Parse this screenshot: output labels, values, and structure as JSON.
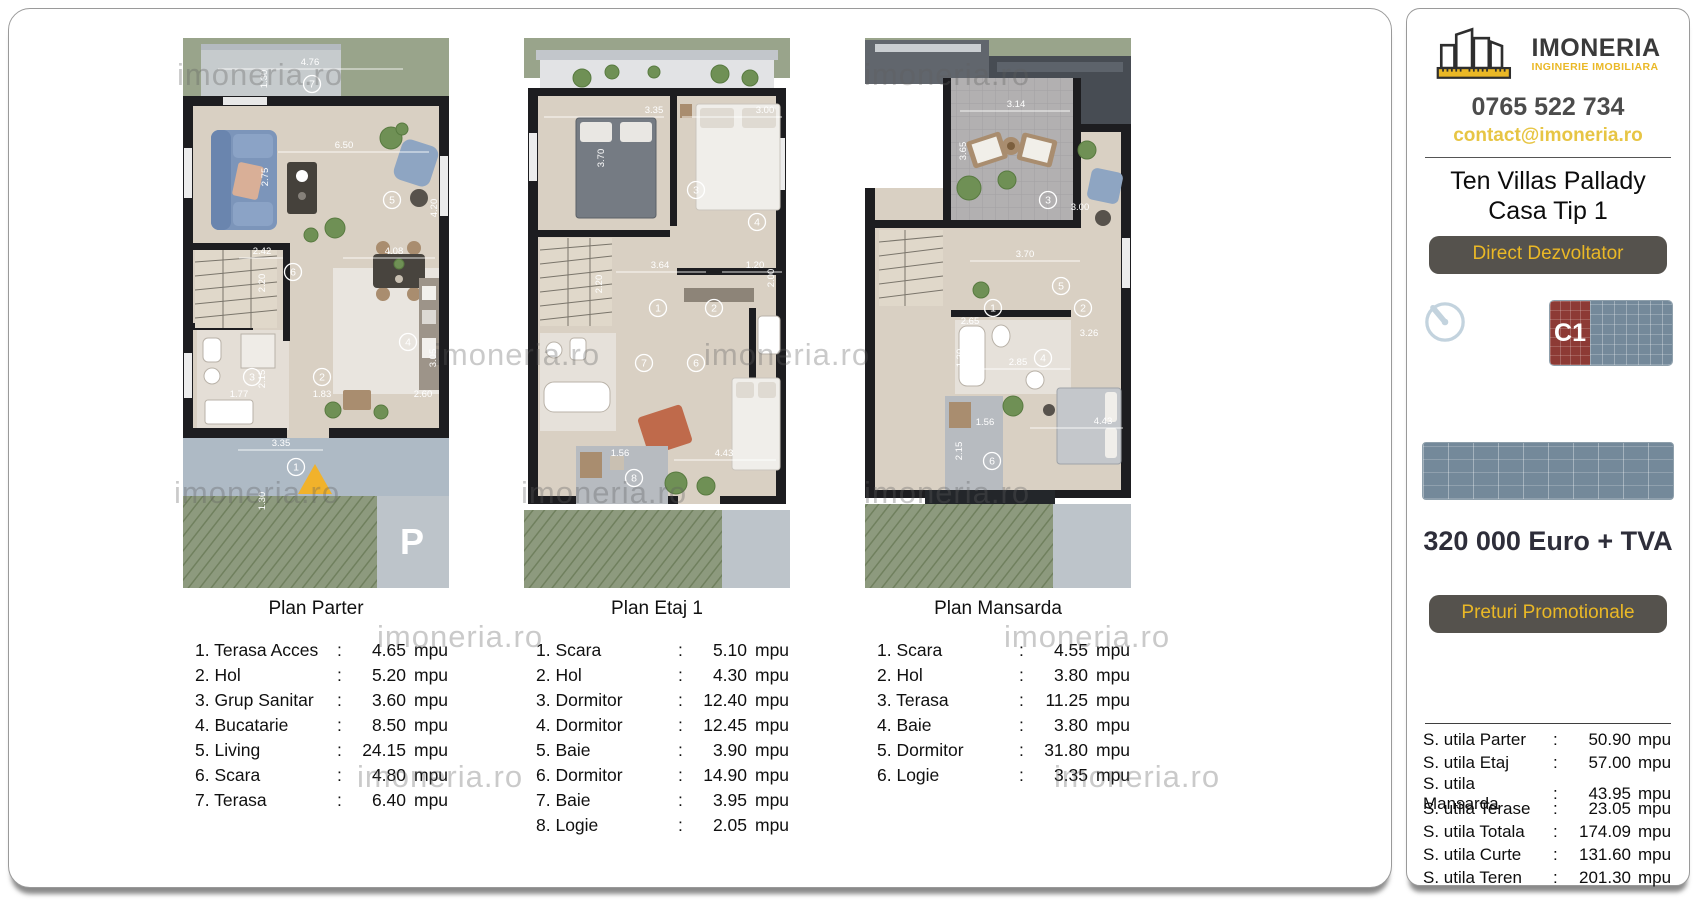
{
  "watermark_text": "imoneria.ro",
  "watermarks": [
    {
      "x": 168,
      "y": 48
    },
    {
      "x": 425,
      "y": 328
    },
    {
      "x": 695,
      "y": 328
    },
    {
      "x": 855,
      "y": 48
    },
    {
      "x": 165,
      "y": 466
    },
    {
      "x": 512,
      "y": 466
    },
    {
      "x": 855,
      "y": 466
    },
    {
      "x": 368,
      "y": 610
    },
    {
      "x": 995,
      "y": 610
    },
    {
      "x": 348,
      "y": 750
    },
    {
      "x": 1045,
      "y": 750
    }
  ],
  "brand": {
    "name": "IMONERIA",
    "tagline": "INGINERIE IMOBILIARA",
    "phone": "0765 522 734",
    "email": "contact@imoneria.ro"
  },
  "listing": {
    "title_line1": "Ten Villas Pallady",
    "title_line2": "Casa Tip 1",
    "developer_badge": "Direct Dezvoltator",
    "price": "320 000 Euro + TVA",
    "promo_button": "Preturi Promotionale",
    "unit_code": "C1"
  },
  "areas": {
    "unit": "mpu",
    "rows": [
      [
        "S. utila Parter",
        "50.90"
      ],
      [
        "S. utila Etaj",
        "57.00"
      ],
      [
        "S. utila Mansarda",
        "43.95"
      ],
      [
        "S. utila Terase",
        "23.05"
      ],
      [
        "S. utila Totala",
        "174.09"
      ],
      [
        "S. utila Curte",
        "131.60"
      ],
      [
        "S. utila Teren",
        "201.30"
      ]
    ]
  },
  "plans": [
    {
      "title": "Plan Parter",
      "unit": "mpu",
      "rooms": [
        [
          "1",
          "Terasa Acces",
          "4.65"
        ],
        [
          "2",
          "Hol",
          "5.20"
        ],
        [
          "3",
          "Grup Sanitar",
          "3.60"
        ],
        [
          "4",
          "Bucatarie",
          "8.50"
        ],
        [
          "5",
          "Living",
          "24.15"
        ],
        [
          "6",
          "Scara",
          "4.80"
        ],
        [
          "7",
          "Terasa",
          "6.40"
        ]
      ],
      "markers": [
        {
          "n": "7",
          "x": 129,
          "y": 46
        },
        {
          "n": "5",
          "x": 209,
          "y": 162
        },
        {
          "n": "6",
          "x": 110,
          "y": 234
        },
        {
          "n": "4",
          "x": 225,
          "y": 304
        },
        {
          "n": "2",
          "x": 139,
          "y": 339
        },
        {
          "n": "3",
          "x": 69,
          "y": 339
        },
        {
          "n": "1",
          "x": 113,
          "y": 429
        }
      ],
      "dims": [
        {
          "t": "4.76",
          "x": 127,
          "y": 27
        },
        {
          "t": "1.30",
          "x": 84,
          "y": 41,
          "v": 1
        },
        {
          "t": "6.50",
          "x": 161,
          "y": 110
        },
        {
          "t": "2.75",
          "x": 85,
          "y": 139,
          "v": 1
        },
        {
          "t": "4.20",
          "x": 254,
          "y": 170,
          "v": 1
        },
        {
          "t": "2.42",
          "x": 79,
          "y": 216
        },
        {
          "t": "4.08",
          "x": 211,
          "y": 216
        },
        {
          "t": "2.20",
          "x": 82,
          "y": 245,
          "v": 1
        },
        {
          "t": "3.05",
          "x": 253,
          "y": 320,
          "v": 1
        },
        {
          "t": "2.15",
          "x": 82,
          "y": 341,
          "v": 1
        },
        {
          "t": "1.77",
          "x": 56,
          "y": 359
        },
        {
          "t": "1.83",
          "x": 139,
          "y": 359
        },
        {
          "t": "2.60",
          "x": 240,
          "y": 359
        },
        {
          "t": "3.35",
          "x": 98,
          "y": 408
        },
        {
          "t": "1.30",
          "x": 82,
          "y": 463,
          "v": 1
        }
      ],
      "big_labels": [
        {
          "t": "P",
          "x": 229,
          "y": 516
        }
      ]
    },
    {
      "title": "Plan Etaj 1",
      "unit": "mpu",
      "rooms": [
        [
          "1",
          "Scara",
          "5.10"
        ],
        [
          "2",
          "Hol",
          "4.30"
        ],
        [
          "3",
          "Dormitor",
          "12.40"
        ],
        [
          "4",
          "Dormitor",
          "12.45"
        ],
        [
          "5",
          "Baie",
          "3.90"
        ],
        [
          "6",
          "Dormitor",
          "14.90"
        ],
        [
          "7",
          "Baie",
          "3.95"
        ],
        [
          "8",
          "Logie",
          "2.05"
        ]
      ],
      "markers": [
        {
          "n": "3",
          "x": 172,
          "y": 152
        },
        {
          "n": "4",
          "x": 233,
          "y": 184
        },
        {
          "n": "1",
          "x": 134,
          "y": 270
        },
        {
          "n": "2",
          "x": 190,
          "y": 270
        },
        {
          "n": "5",
          "x": 246,
          "y": 295
        },
        {
          "n": "7",
          "x": 120,
          "y": 325
        },
        {
          "n": "6",
          "x": 172,
          "y": 325
        },
        {
          "n": "8",
          "x": 110,
          "y": 440
        }
      ],
      "dims": [
        {
          "t": "3.35",
          "x": 130,
          "y": 75
        },
        {
          "t": "3.00",
          "x": 241,
          "y": 75
        },
        {
          "t": "3.70",
          "x": 80,
          "y": 120,
          "v": 1
        },
        {
          "t": "3.64",
          "x": 136,
          "y": 230
        },
        {
          "t": "1.20",
          "x": 231,
          "y": 230
        },
        {
          "t": "2.20",
          "x": 78,
          "y": 246,
          "v": 1
        },
        {
          "t": "2.00",
          "x": 250,
          "y": 240,
          "v": 1
        },
        {
          "t": "1.56",
          "x": 96,
          "y": 418
        },
        {
          "t": "4.43",
          "x": 200,
          "y": 418
        }
      ],
      "big_labels": []
    },
    {
      "title": "Plan Mansarda",
      "unit": "mpu",
      "rooms": [
        [
          "1",
          "Scara",
          "4.55"
        ],
        [
          "2",
          "Hol",
          "3.80"
        ],
        [
          "3",
          "Terasa",
          "11.25"
        ],
        [
          "4",
          "Baie",
          "3.80"
        ],
        [
          "5",
          "Dormitor",
          "31.80"
        ],
        [
          "6",
          "Logie",
          "3.35"
        ]
      ],
      "markers": [
        {
          "n": "3",
          "x": 183,
          "y": 162
        },
        {
          "n": "5",
          "x": 196,
          "y": 248
        },
        {
          "n": "1",
          "x": 128,
          "y": 270
        },
        {
          "n": "2",
          "x": 218,
          "y": 270
        },
        {
          "n": "4",
          "x": 178,
          "y": 320
        },
        {
          "n": "6",
          "x": 127,
          "y": 423
        }
      ],
      "dims": [
        {
          "t": "3.14",
          "x": 151,
          "y": 69
        },
        {
          "t": "3.65",
          "x": 101,
          "y": 113,
          "v": 1
        },
        {
          "t": "3.00",
          "x": 215,
          "y": 172
        },
        {
          "t": "3.70",
          "x": 160,
          "y": 219
        },
        {
          "t": "2.65",
          "x": 105,
          "y": 286
        },
        {
          "t": "3.26",
          "x": 224,
          "y": 298
        },
        {
          "t": "2.85",
          "x": 153,
          "y": 327
        },
        {
          "t": "1.30",
          "x": 98,
          "y": 320,
          "v": 1
        },
        {
          "t": "1.56",
          "x": 120,
          "y": 387
        },
        {
          "t": "4.43",
          "x": 238,
          "y": 386
        },
        {
          "t": "2.15",
          "x": 97,
          "y": 413,
          "v": 1
        }
      ],
      "big_labels": []
    }
  ]
}
